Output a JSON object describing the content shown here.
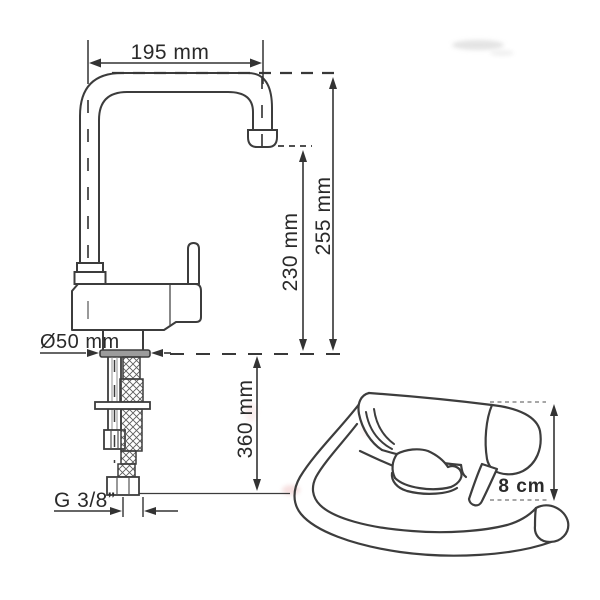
{
  "page": {
    "background": "#ffffff"
  },
  "diagram": {
    "description": "Technical dimension drawing of a single-lever kitchen faucet with fold-down spout",
    "colors": {
      "line": "#3c3c3c",
      "text": "#2a2a2a",
      "flange_fill": "#9c9c9c"
    },
    "labels": {
      "spout_reach": "195 mm",
      "total_height": "255 mm",
      "spout_height": "230 mm",
      "base_diameter": "Ø50 mm",
      "under_counter_length": "360 mm",
      "thread_size": "G 3/8”",
      "folded_height": "8 cm"
    }
  }
}
